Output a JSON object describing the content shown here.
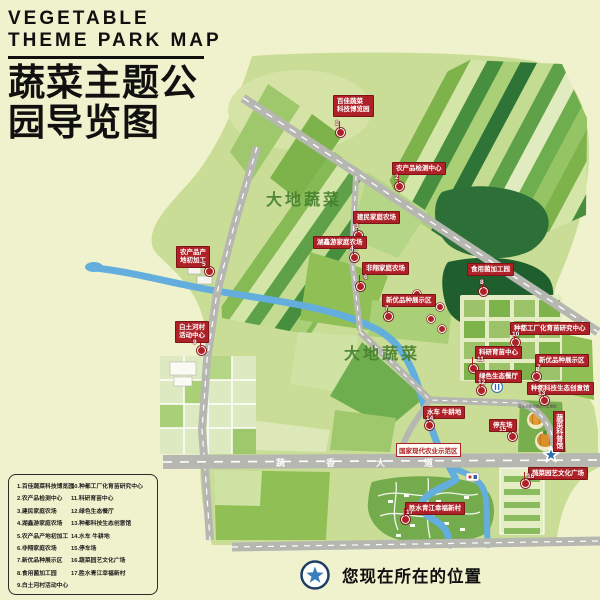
{
  "title": {
    "en_line1": "VEGETABLE",
    "en_line2": "THEME PARK MAP",
    "zh_line1": "蔬菜主题公",
    "zh_line2": "园导览图"
  },
  "map": {
    "region_label_1": "大地蔬菜",
    "region_label_2": "大地蔬菜",
    "road_name_chars": [
      "蔬",
      "香",
      "大",
      "道"
    ],
    "demo_zone_label": "国家现代农业示范区",
    "ribbon_label": "蔬菜科普馆",
    "sculpture_caption": "蔬菜大师浮雕及大型雕塑",
    "markers": [
      {
        "num": "1",
        "line1": "百佳蔬菜",
        "line2": "科技博览园"
      },
      {
        "num": "2",
        "line1": "农产品检测中心"
      },
      {
        "num": "3",
        "line1": "建民家庭农场"
      },
      {
        "num": "4",
        "line1": "湖鑫游家庭农场"
      },
      {
        "num": "5",
        "line1": "农产品产",
        "line2": "地初加工"
      },
      {
        "num": "6",
        "line1": "非翔家庭农场"
      },
      {
        "num": "7",
        "line1": "新优品种展示区"
      },
      {
        "num": "8",
        "line1": "食用菌加工园"
      },
      {
        "num": "9",
        "line1": "白土河村",
        "line2": "活动中心"
      },
      {
        "num": "10",
        "line1": "种都工厂化育苗研究中心"
      },
      {
        "num": "11",
        "line1": "科研育苗中心"
      },
      {
        "num": "7",
        "line1": "新优品种展示区"
      },
      {
        "num": "12",
        "line1": "绿色生态餐厅"
      },
      {
        "num": "13",
        "line1": "种都科技生态创意馆"
      },
      {
        "num": "14",
        "line1": "水车 牛耕地"
      },
      {
        "num": "15",
        "line1": "停车场"
      },
      {
        "num": "16",
        "line1": "蔬菜园艺文化广场"
      },
      {
        "num": "17",
        "line1": "胜水青江幸福新村"
      }
    ]
  },
  "legend": {
    "items": [
      "1.百佳蔬菜科技博览园",
      "2.农产品检测中心",
      "3.建民家庭农场",
      "4.湖鑫游家庭农场",
      "5.农产品产地初加工",
      "6.非翔家庭农场",
      "7.新优品种展示区",
      "8.食用菌加工园",
      "9.白土河村活动中心",
      "10.种都工厂化育苗研究中心",
      "11.科研育苗中心",
      "12.绿色生态餐厅",
      "13.种都科技生态创意馆",
      "14.水车 牛耕地",
      "15.停车场",
      "16.蔬菜园艺文化广场",
      "17.胜水青江幸福新村"
    ]
  },
  "you_are_here": "您现在所在的位置",
  "colors": {
    "label_red": "#ae2127",
    "river_blue": "#63aedd",
    "road_gray": "#b7b7b2",
    "star_blue": "#2f6fae",
    "page_bg": "#f0f2cd"
  }
}
